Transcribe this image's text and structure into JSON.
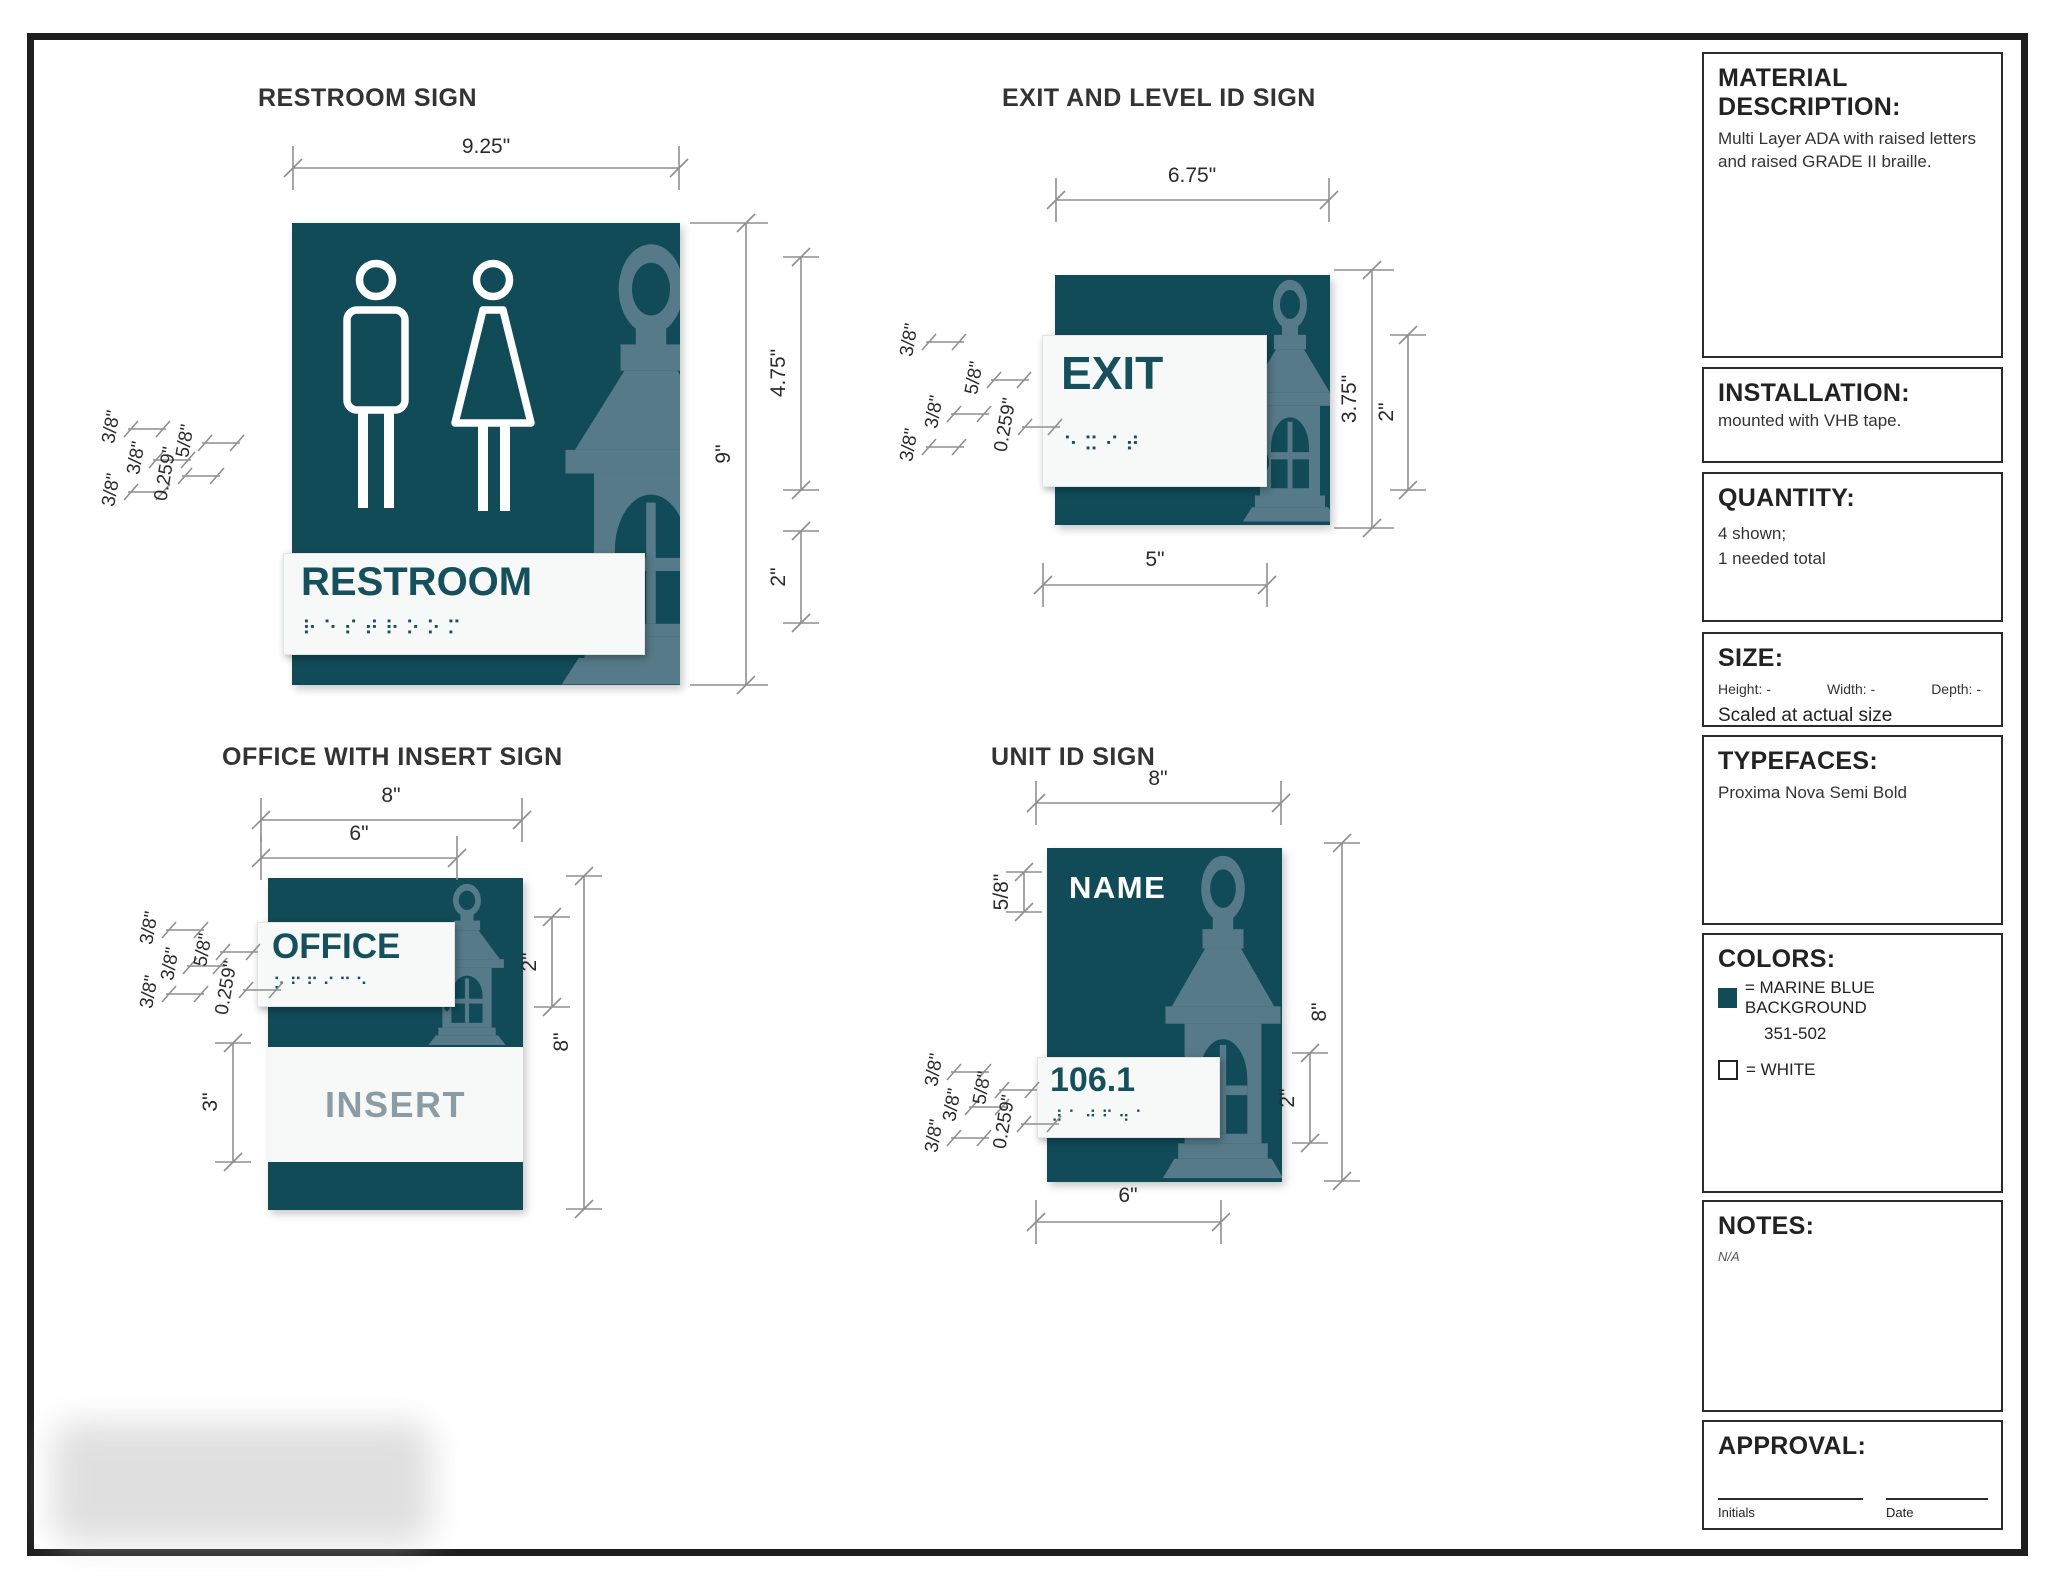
{
  "page": {
    "background": "#ffffff",
    "frame_color": "#1e1e1e"
  },
  "palette": {
    "marine_blue": "#114B58",
    "lantern_slate": "#567A89",
    "plate_white": "#F7F8F8",
    "sign_text_teal": "#16505C",
    "insert_gray": "#8C9CA4",
    "dimension_line": "#8f8f8f"
  },
  "signs": {
    "restroom": {
      "title": "RESTROOM SIGN",
      "plate_text": "RESTROOM",
      "braille": "⠗⠑⠎⠞⠗⠕⠕⠍",
      "width": "9.25\"",
      "height": "9\"",
      "upper": "4.75\"",
      "plate_h": "2\"",
      "off1": "3/8\"",
      "off2": "5/8\"",
      "off3": "3/8\"",
      "off4": "3/8\"",
      "off5": "0.259\""
    },
    "exit": {
      "title": "EXIT AND LEVEL ID SIGN",
      "plate_text": "EXIT",
      "braille": "⠑⠭⠊⠞",
      "width": "6.75\"",
      "height": "3.75\"",
      "plate_h": "2\"",
      "plate_w": "5\"",
      "off1": "3/8\"",
      "off2": "5/8\"",
      "off3": "3/8\"",
      "off4": "3/8\"",
      "off5": "0.259\""
    },
    "office": {
      "title": "OFFICE WITH INSERT SIGN",
      "plate_text": "OFFICE",
      "braille": "⠕⠋⠋⠊⠉⠑",
      "insert_text": "INSERT",
      "width": "8\"",
      "plate_w": "6\"",
      "plate_h": "2\"",
      "height": "8\"",
      "insert_h": "3\"",
      "off1": "3/8\"",
      "off2": "5/8\"",
      "off3": "3/8\"",
      "off4": "3/8\"",
      "off5": "0.259\""
    },
    "unit": {
      "title": "UNIT ID SIGN",
      "name_text": "NAME",
      "plate_text": "106.1",
      "braille": "⠼⠁⠚⠋⠲⠁",
      "width": "8\"",
      "height": "8\"",
      "plate_h": "2\"",
      "plate_w": "6\"",
      "name_off": "5/8\"",
      "off1": "3/8\"",
      "off2": "5/8\"",
      "off3": "3/8\"",
      "off4": "3/8\"",
      "off5": "0.259\""
    }
  },
  "sidebar": {
    "material": {
      "title": "MATERIAL DESCRIPTION:",
      "body": "Multi Layer ADA with raised letters and raised GRADE II braille."
    },
    "installation": {
      "title": "INSTALLATION:",
      "body": "mounted with VHB tape."
    },
    "quantity": {
      "title": "QUANTITY:",
      "body1": "4 shown;",
      "body2": "1 needed total"
    },
    "size": {
      "title": "SIZE:",
      "height": "Height: -",
      "width": "Width: -",
      "depth": "Depth: -",
      "note": "Scaled at actual size"
    },
    "typefaces": {
      "title": "TYPEFACES:",
      "body": "Proxima Nova Semi Bold"
    },
    "colors": {
      "title": "COLORS:",
      "marine": "= MARINE BLUE BACKGROUND",
      "marine_code": "351-502",
      "white": "= WHITE"
    },
    "notes": {
      "title": "NOTES:",
      "body": "N/A"
    },
    "approval": {
      "title": "APPROVAL:",
      "initials": "Initials",
      "date": "Date"
    }
  }
}
